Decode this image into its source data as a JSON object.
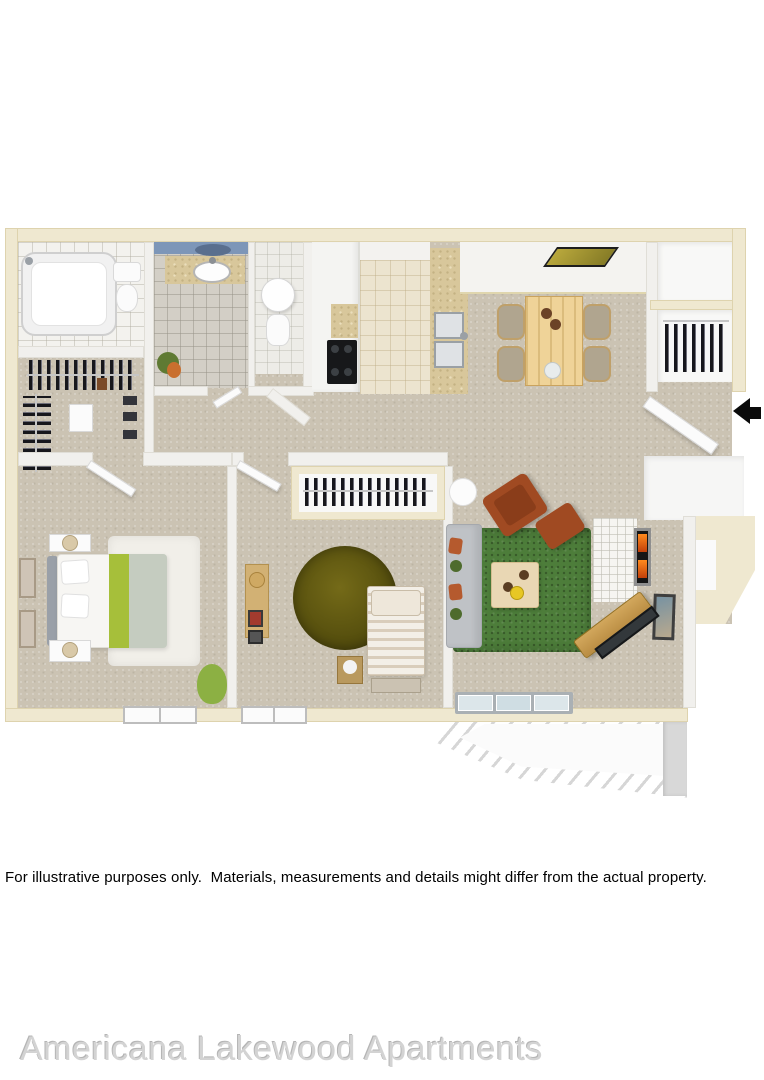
{
  "disclaimer": {
    "text": "For illustrative purposes only.  Materials, measurements and details might differ from the actual property."
  },
  "watermark": {
    "text": "Americana Lakewood Apartments"
  },
  "floorplan": {
    "type": "3d-top-down-floor-plan",
    "unit": "two-bedroom two-bath apartment with balcony",
    "rooms": [
      "bathroom-1",
      "walk-in-closet",
      "bathroom-2",
      "toilet-room",
      "kitchen",
      "dining-area",
      "entry",
      "hall-closets",
      "master-bedroom",
      "bedroom-2",
      "living-room",
      "balcony"
    ],
    "furniture": [
      "bathtub",
      "toilets",
      "vanity-sink",
      "clothes-racks",
      "refrigerator-cabinets",
      "stove-cooktop",
      "double-kitchen-sink",
      "breakfast-bar",
      "dining-table",
      "dining-chairs",
      "wall-art",
      "coat-closet",
      "entry-door",
      "queen-bed",
      "nightstands",
      "lamps",
      "white-shag-rug",
      "bean-bag",
      "dresser",
      "round-olive-rug",
      "twin-bed",
      "foot-bench",
      "sofa",
      "armchair",
      "ottoman",
      "coffee-table",
      "side-table",
      "fireplace",
      "tv-console",
      "sliding-glass-door",
      "balcony-railing"
    ],
    "palette": {
      "outer_wall": "#efe8d0",
      "inner_wall": "#f1f0ed",
      "carpet": "#cbc3b3",
      "bath_tile": "#d3cfc6",
      "kitchen_tile": "#ece4cf",
      "granite": "#d8c79b",
      "bath_accent_blue": "#7d96b8",
      "living_rug_green": "#4d7d3a",
      "bedroom_rug_olive": "#57500e",
      "accent_rust": "#a04a22",
      "bed_throw_green": "#a6bf3a",
      "entry_arrow": "#000000"
    }
  }
}
